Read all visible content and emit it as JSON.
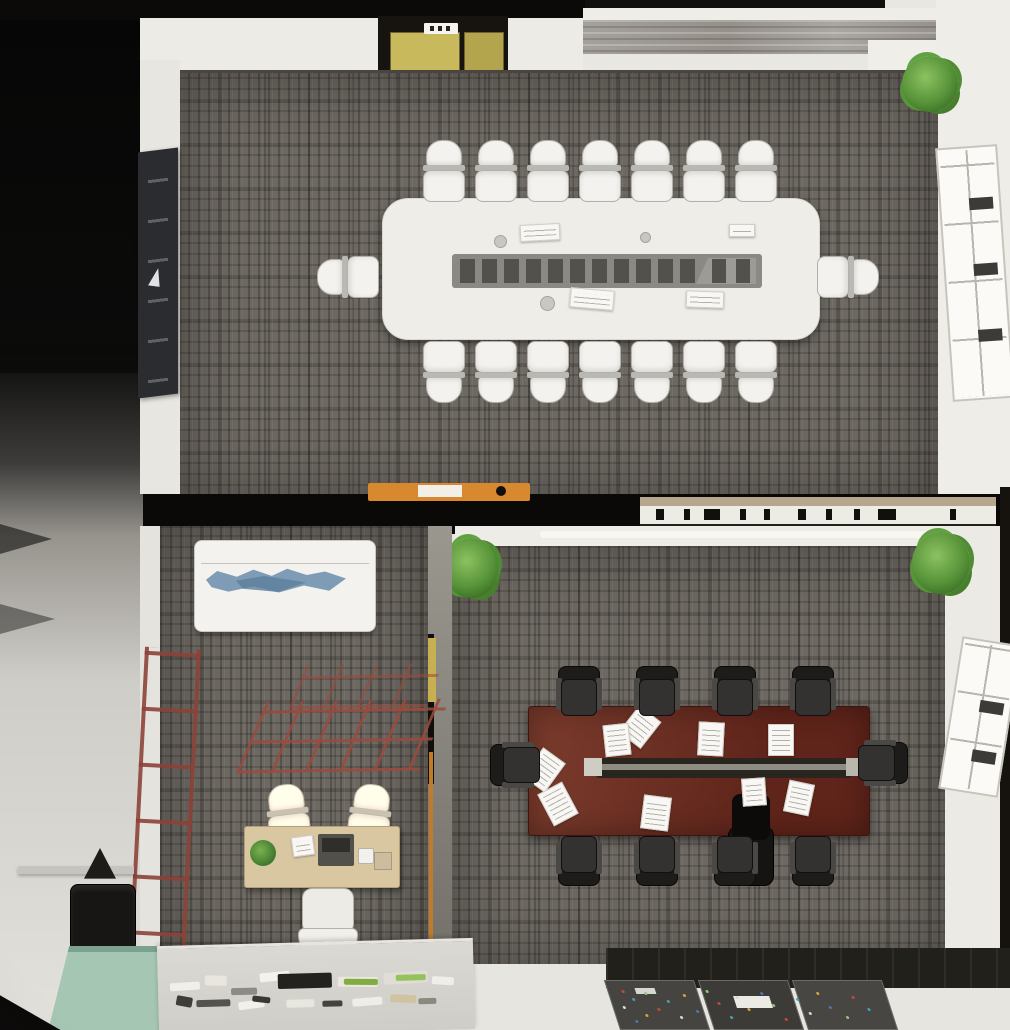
{
  "title": "Top-down 3D render of a two-room office suite with conference tables",
  "palette": {
    "carpet": "#6d6862",
    "wall_white": "#efede7",
    "wall_black": "#0b0a09",
    "wood_strip": "#95908a",
    "elevator_yellow": "#c8b95c",
    "display_panel": "#2b2c30",
    "table_white": "#eeede8",
    "media_strip": "#8a8984",
    "media_segment": "#53514b",
    "chair_white": "#f3f2ee",
    "divider_orange": "#d8892f",
    "counter_white": "#ecebe4",
    "counter_tan": "#b5a68d",
    "table_mahogany_light": "#7b3c2d",
    "table_mahogany_dark": "#5f241a",
    "chair_black": "#343230",
    "plant_green": "#569238",
    "sofa_white": "#f3f2ee",
    "throw_blue": "#7e9cb6",
    "desk_wood": "#d9c7a2",
    "chair_cream": "#e9e6d2",
    "ladder_red": "#8c4238",
    "teal_floor": "#a6c6b4",
    "window_mullion": "#3d3b37",
    "swatch_board": "#403f3b"
  },
  "scene": {
    "rooms": [
      {
        "id": "meeting-room-large",
        "label": "Large meeting room",
        "floor": "gray basket-weave carpet tiles",
        "table": {
          "kind": "white rounded conference table with central media strip",
          "media_segments": 11,
          "notepads": 4,
          "cups": 3
        },
        "chairs": {
          "style": "white task chairs",
          "top_row": 7,
          "bottom_row": 7,
          "end_seats": 2,
          "total": 16
        },
        "features": [
          "wall-mounted display on left wall",
          "yellow elevator doors at top",
          "wood plank floor strip along top wall",
          "mullioned window on right wall",
          "potted plant in top-right corner"
        ]
      },
      {
        "id": "office-lounge",
        "label": "Small office / lounge",
        "furniture": [
          "white sofa with blue throw",
          "red metal frame shelving on floor",
          "wood desk with two cream guest chairs",
          "white task chair",
          "red ladder rack against left wall"
        ]
      },
      {
        "id": "meeting-room-mahogany",
        "label": "Mahogany meeting room",
        "table": {
          "kind": "dark mahogany rectangular table",
          "papers": 9,
          "black_device": 1
        },
        "chairs": {
          "style": "black office chairs",
          "top_row": 4,
          "bottom_row": 4,
          "end_seats": 2,
          "total": 10
        },
        "features": [
          "two potted plants at top corners",
          "mullioned window on right wall",
          "dark sample boards with color chips at bottom"
        ]
      }
    ],
    "divider": {
      "credenza": "orange sideboard on meeting-room side",
      "counter": "white counter with books and devices",
      "counter_items": 10
    },
    "exterior": [
      "dark walls at top-left",
      "gray shelving along left edge",
      "black lounge chair bottom-left",
      "teal floor mat",
      "stationery counter with office supplies"
    ],
    "stationery_items": 19,
    "swatch_dots": 26
  }
}
